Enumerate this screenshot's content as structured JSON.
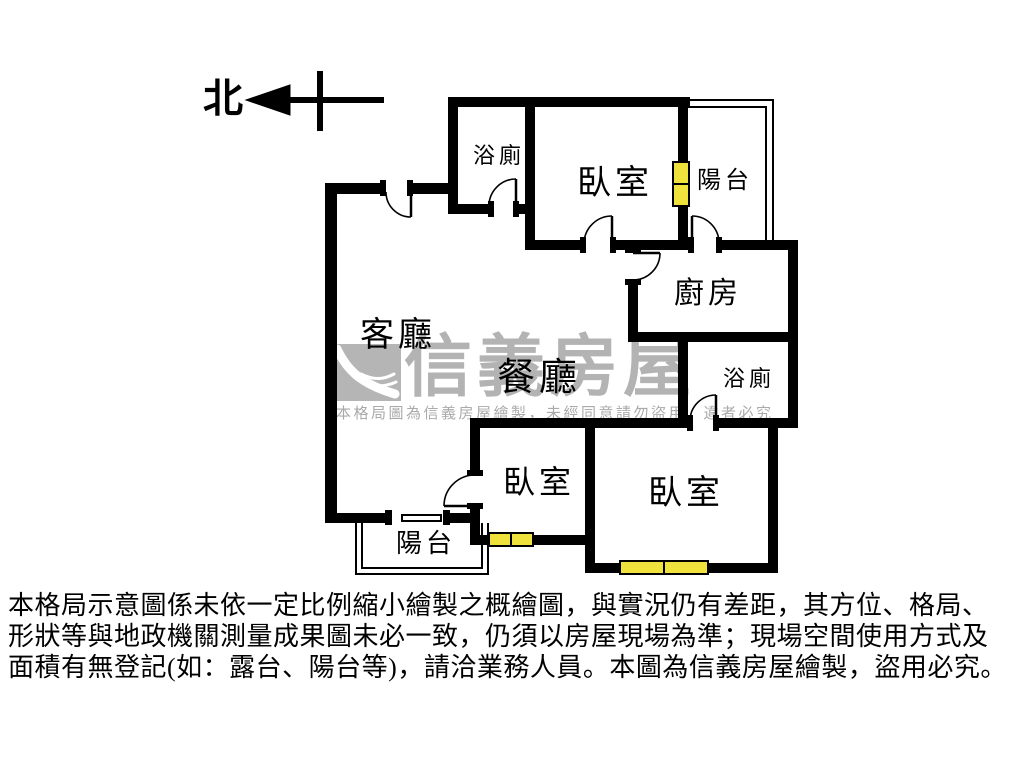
{
  "north": {
    "label": "北"
  },
  "rooms": {
    "bath_top": "浴廁",
    "bedroom_top": "臥室",
    "balcony_top": "陽台",
    "kitchen": "廚房",
    "bath_right": "浴廁",
    "living": "客廳",
    "dining": "餐廳",
    "bedroom_mid": "臥室",
    "bedroom_right": "臥室",
    "balcony_bottom": "陽台"
  },
  "watermark": {
    "brand": "信義房屋",
    "notice": "本格局圖為信義房屋繪製，未經同意請勿盜用，違者必究",
    "logo_color": "#b5b5b5",
    "text_color": "#b3b3b3"
  },
  "disclaimer": {
    "line1": "本格局示意圖係未依一定比例縮小繪製之概繪圖，與實況仍有差距，其方位、格局、",
    "line2": "形狀等與地政機關測量成果圖未必一致，仍須以房屋現場為準；現場空間使用方式及",
    "line3": "面積有無登記(如：露台、陽台等)，請洽業務人員。本圖為信義房屋繪製，盜用必究。"
  },
  "colors": {
    "wall": "#000000",
    "window_fill": "#f0e23c",
    "window_frame": "#000000",
    "watermark_gray": "#b3b3b3"
  }
}
